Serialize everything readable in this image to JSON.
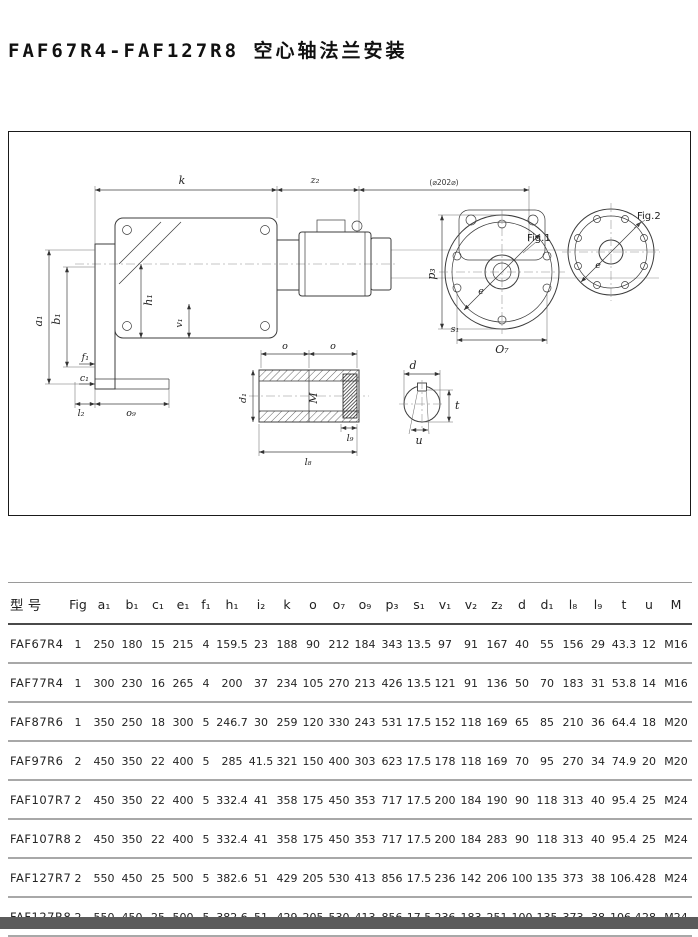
{
  "page": {
    "title": "FAF67R4-FAF127R8 空心轴法兰安装"
  },
  "drawing": {
    "labels": {
      "k": "k",
      "z2": "z₂",
      "motor_note": "(⌀202⌀)",
      "a1": "a₁",
      "b1": "b₁",
      "h1": "h₁",
      "v1": "v₁",
      "f1": "f₁",
      "c1": "c₁",
      "l2": "l₂",
      "o9": "o₉",
      "p3": "p₃",
      "fig1": "Fig.1",
      "fig2": "Fig.2",
      "s1": "s₁",
      "o7": "O₇",
      "e_fig1": "e",
      "e_fig2": "e",
      "o_left": "o",
      "o_right": "o",
      "d1": "d₁",
      "m": "M",
      "l9": "l₉",
      "l8": "l₈",
      "d": "d",
      "t": "t",
      "u": "u"
    }
  },
  "table": {
    "columns": [
      "型 号",
      "Fig",
      "a₁",
      "b₁",
      "c₁",
      "e₁",
      "f₁",
      "h₁",
      "i₂",
      "k",
      "o",
      "o₇",
      "o₉",
      "p₃",
      "s₁",
      "v₁",
      "v₂",
      "z₂",
      "d",
      "d₁",
      "l₈",
      "l₉",
      "t",
      "u",
      "M"
    ],
    "rows": [
      [
        "FAF67R4",
        "1",
        "250",
        "180",
        "15",
        "215",
        "4",
        "159.5",
        "23",
        "188",
        "90",
        "212",
        "184",
        "343",
        "13.5",
        "97",
        "91",
        "167",
        "40",
        "55",
        "156",
        "29",
        "43.3",
        "12",
        "M16"
      ],
      [
        "FAF77R4",
        "1",
        "300",
        "230",
        "16",
        "265",
        "4",
        "200",
        "37",
        "234",
        "105",
        "270",
        "213",
        "426",
        "13.5",
        "121",
        "91",
        "136",
        "50",
        "70",
        "183",
        "31",
        "53.8",
        "14",
        "M16"
      ],
      [
        "FAF87R6",
        "1",
        "350",
        "250",
        "18",
        "300",
        "5",
        "246.7",
        "30",
        "259",
        "120",
        "330",
        "243",
        "531",
        "17.5",
        "152",
        "118",
        "169",
        "65",
        "85",
        "210",
        "36",
        "64.4",
        "18",
        "M20"
      ],
      [
        "FAF97R6",
        "2",
        "450",
        "350",
        "22",
        "400",
        "5",
        "285",
        "41.5",
        "321",
        "150",
        "400",
        "303",
        "623",
        "17.5",
        "178",
        "118",
        "169",
        "70",
        "95",
        "270",
        "34",
        "74.9",
        "20",
        "M20"
      ],
      [
        "FAF107R7",
        "2",
        "450",
        "350",
        "22",
        "400",
        "5",
        "332.4",
        "41",
        "358",
        "175",
        "450",
        "353",
        "717",
        "17.5",
        "200",
        "184",
        "190",
        "90",
        "118",
        "313",
        "40",
        "95.4",
        "25",
        "M24"
      ],
      [
        "FAF107R8",
        "2",
        "450",
        "350",
        "22",
        "400",
        "5",
        "332.4",
        "41",
        "358",
        "175",
        "450",
        "353",
        "717",
        "17.5",
        "200",
        "184",
        "283",
        "90",
        "118",
        "313",
        "40",
        "95.4",
        "25",
        "M24"
      ],
      [
        "FAF127R7",
        "2",
        "550",
        "450",
        "25",
        "500",
        "5",
        "382.6",
        "51",
        "429",
        "205",
        "530",
        "413",
        "856",
        "17.5",
        "236",
        "142",
        "206",
        "100",
        "135",
        "373",
        "38",
        "106.4",
        "28",
        "M24"
      ],
      [
        "FAF127R8",
        "2",
        "550",
        "450",
        "25",
        "500",
        "5",
        "382.6",
        "51",
        "429",
        "205",
        "530",
        "413",
        "856",
        "17.5",
        "236",
        "183",
        "251",
        "100",
        "135",
        "373",
        "38",
        "106.4",
        "28",
        "M24"
      ]
    ]
  }
}
